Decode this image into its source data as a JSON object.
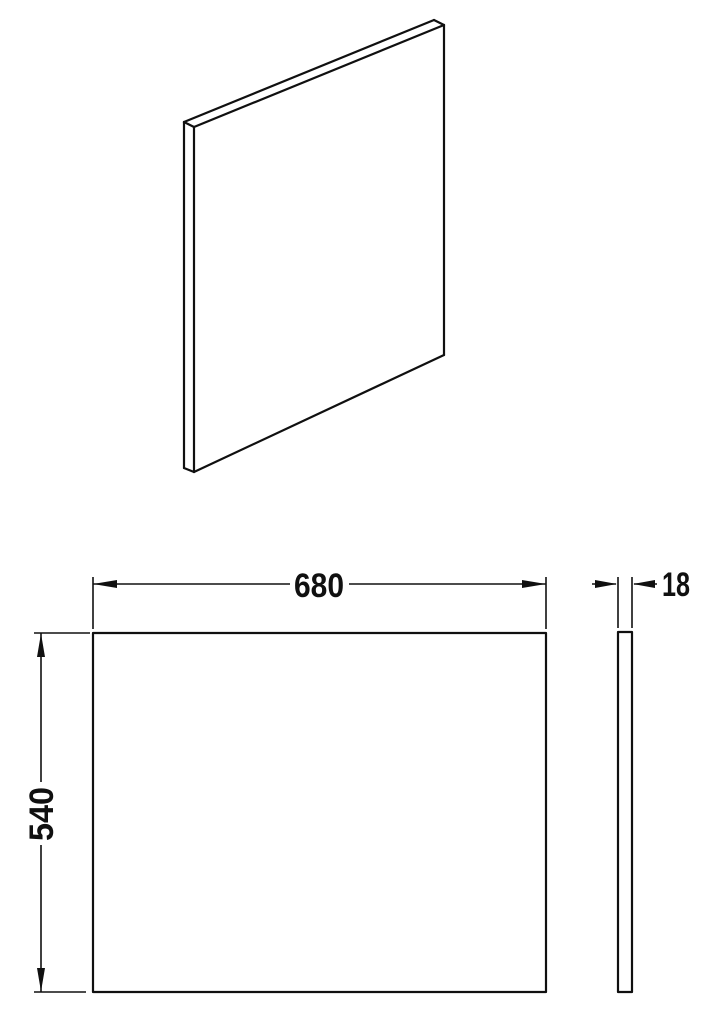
{
  "diagram": {
    "type": "technical-drawing",
    "subject": "flat rectangular panel",
    "views": {
      "isometric": "isometric-view",
      "front": "front-view",
      "side": "side-view"
    },
    "dimensions": {
      "width_label": "680",
      "height_label": "540",
      "thickness_label": "18"
    },
    "colors": {
      "line": "#101010",
      "background": "#ffffff"
    }
  }
}
